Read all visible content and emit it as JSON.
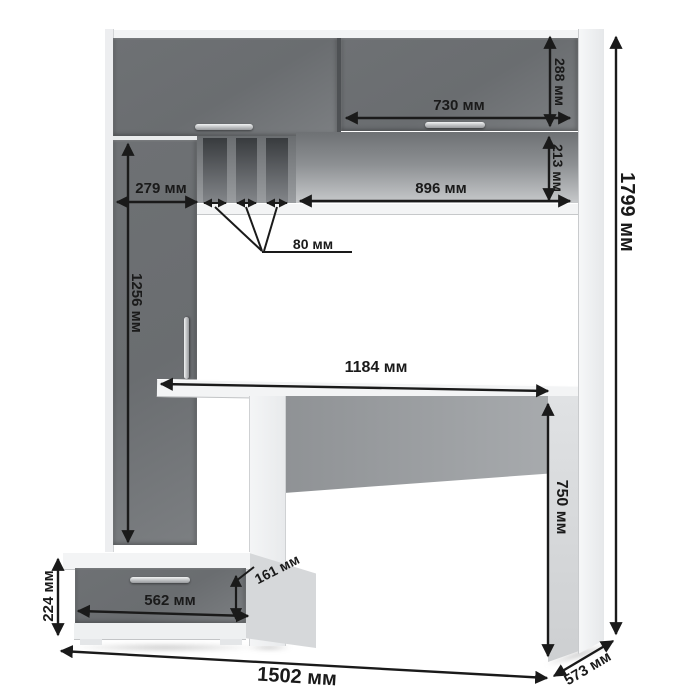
{
  "diagram": {
    "unit": "мм",
    "dimensions": {
      "overall_height": "1799 мм",
      "overall_width": "1502 мм",
      "overall_depth": "573 мм",
      "hutch_door_height": "288 мм",
      "hutch_right_door_width": "730 мм",
      "shelf_niche_height": "213 мм",
      "shelf_niche_width": "896 мм",
      "left_section_width": "279 мм",
      "left_door_height": "1256 мм",
      "pigeonhole_slot_width": "80 мм",
      "desktop_width": "1184 мм",
      "desk_height": "750 мм",
      "drawer_width": "562 мм",
      "drawer_front_height": "161 мм",
      "pedestal_height": "224 мм"
    },
    "colors": {
      "front_panels_dark": "#6c6f72",
      "carcass_light": "#f3f4f5",
      "dimension_ink": "#1a1a1a",
      "background": "#ffffff"
    }
  }
}
